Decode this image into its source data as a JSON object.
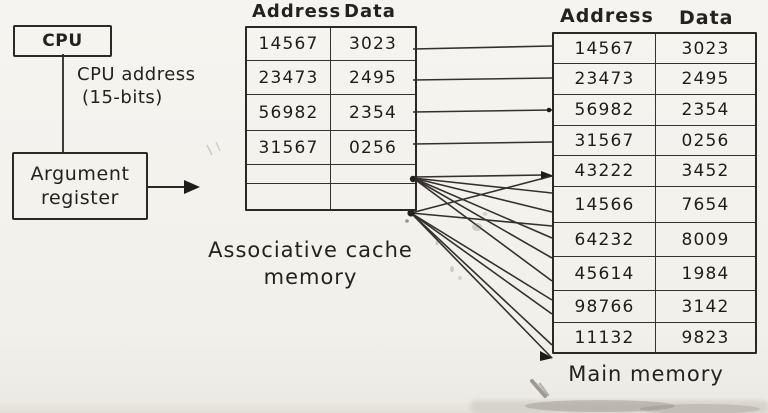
{
  "cpu_box": {
    "label": "CPU"
  },
  "cpu_address_note": {
    "line1": "CPU address",
    "line2": "(15-bits)"
  },
  "argument_register_box": {
    "line1": "Argument",
    "line2": "register"
  },
  "cache_table": {
    "header": {
      "address": "Address",
      "data": "Data"
    },
    "rows": [
      {
        "address": "14567",
        "data": "3023"
      },
      {
        "address": "23473",
        "data": "2495"
      },
      {
        "address": "56982",
        "data": "2354"
      },
      {
        "address": "31567",
        "data": "0256"
      },
      {
        "address": "",
        "data": ""
      },
      {
        "address": "",
        "data": ""
      }
    ],
    "caption_line1": "Associative cache",
    "caption_line2": "memory"
  },
  "main_memory_table": {
    "header": {
      "address": "Address",
      "data": "Data"
    },
    "rows": [
      {
        "address": "14567",
        "data": "3023"
      },
      {
        "address": "23473",
        "data": "2495"
      },
      {
        "address": "56982",
        "data": "2354"
      },
      {
        "address": "31567",
        "data": "0256"
      },
      {
        "address": "43222",
        "data": "3452"
      },
      {
        "address": "14566",
        "data": "7654"
      },
      {
        "address": "64232",
        "data": "8009"
      },
      {
        "address": "45614",
        "data": "1984"
      },
      {
        "address": "98766",
        "data": "3142"
      },
      {
        "address": "11132",
        "data": "9823"
      }
    ],
    "caption": "Main memory"
  },
  "colors": {
    "ink": "#2b2826",
    "paper": "#f2f0ea"
  }
}
